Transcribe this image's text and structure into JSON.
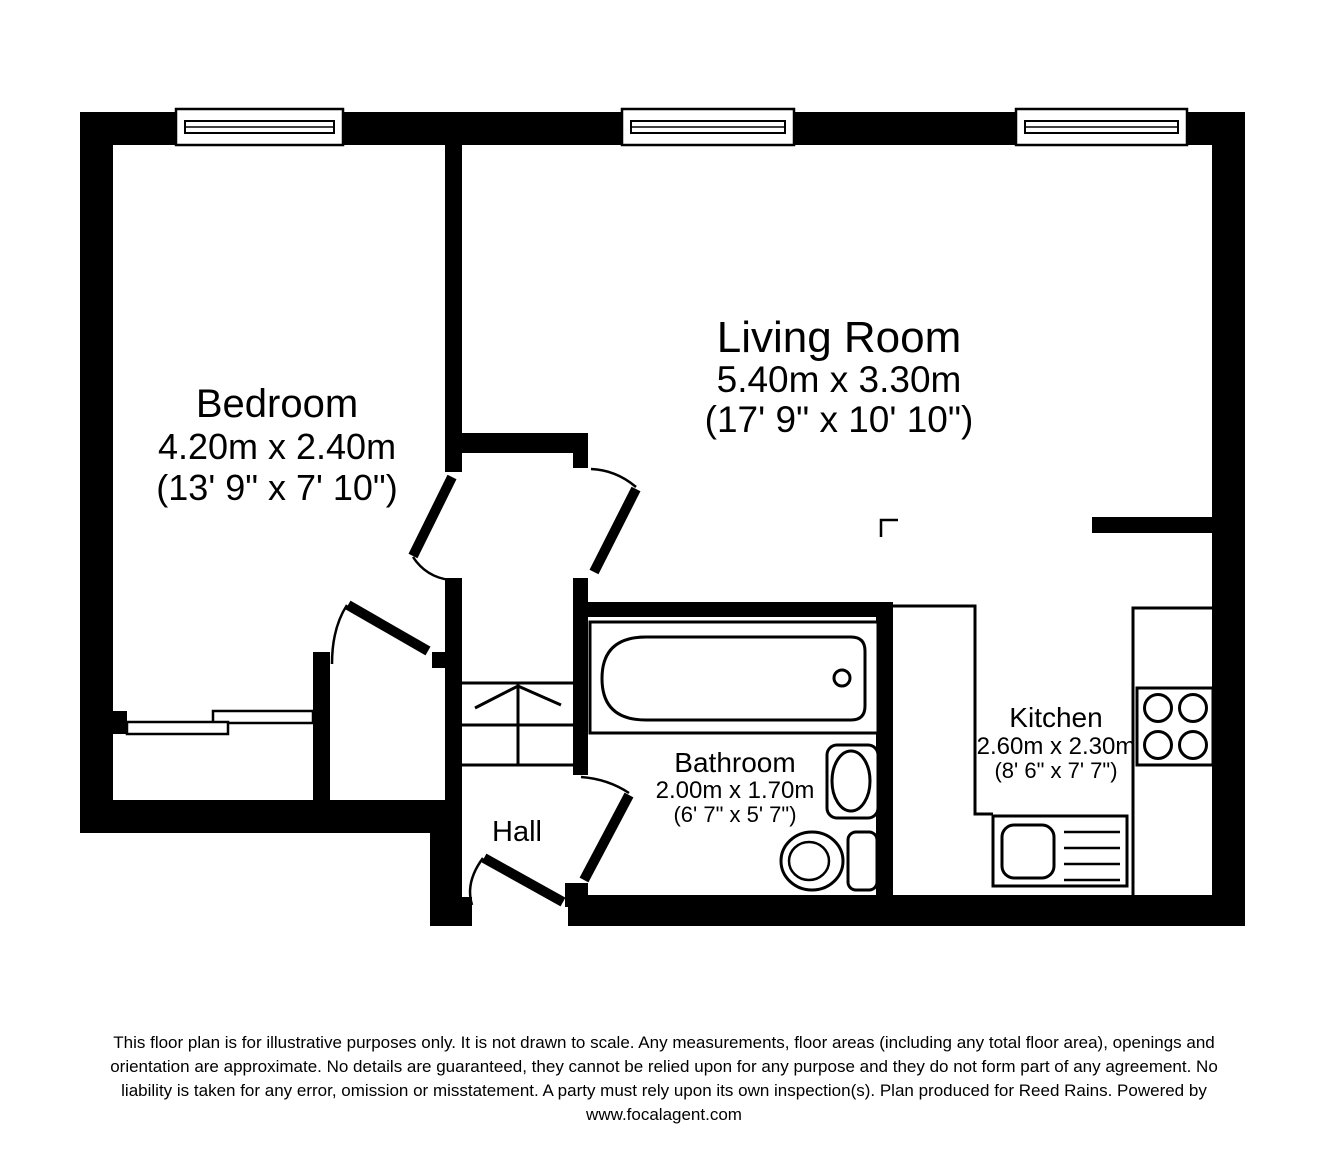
{
  "plan": {
    "rooms": {
      "bedroom": {
        "name": "Bedroom",
        "metric": "4.20m x 2.40m",
        "imperial": "(13' 9\" x 7' 10\")"
      },
      "living_room": {
        "name": "Living Room",
        "metric": "5.40m x 3.30m",
        "imperial": "(17' 9\" x 10' 10\")"
      },
      "bathroom": {
        "name": "Bathroom",
        "metric": "2.00m x 1.70m",
        "imperial": "(6' 7\" x 5' 7\")"
      },
      "kitchen": {
        "name": "Kitchen",
        "metric": "2.60m x 2.30m",
        "imperial": "(8' 6\" x 7' 7\")"
      },
      "hall": {
        "name": "Hall"
      }
    },
    "colors": {
      "wall": "#000000",
      "floor": "#ffffff"
    }
  },
  "disclaimer": {
    "lines": [
      "This floor plan is for illustrative purposes only. It is not drawn to scale. Any measurements, floor areas (including any total floor area), openings and",
      "orientation are approximate. No details are guaranteed, they cannot be relied upon for any purpose and they do not form part of any agreement. No",
      "liability is taken for any error, omission or misstatement. A party must rely upon its own inspection(s). Plan produced for Reed Rains. Powered by",
      "www.focalagent.com"
    ]
  }
}
